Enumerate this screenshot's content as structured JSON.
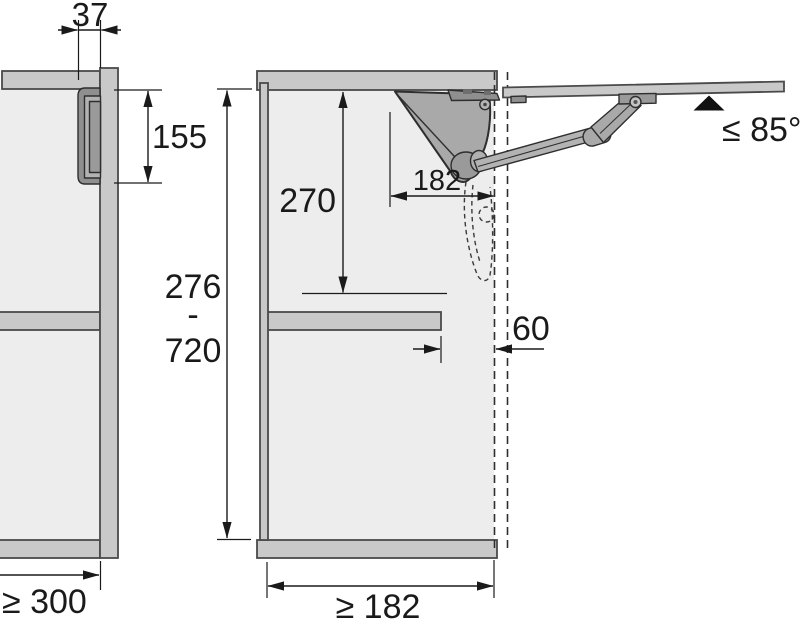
{
  "diagram": {
    "type": "technical-installation-drawing",
    "subject": "cabinet lift-up flap fitting mounting dimensions, front view and side section view",
    "dimensions": {
      "fitting_front_width": "37",
      "fitting_front_height": "155",
      "min_cabinet_side_depth": "≥ 300",
      "interior_clearance_height": "270",
      "fitting_depth": "182",
      "shelf_setback": "60",
      "min_interior_depth": "≥ 182",
      "flap_height_min": "276",
      "flap_height_separator": "-",
      "flap_height_max": "720",
      "max_opening_angle": "≤ 85°"
    },
    "colors": {
      "panel": "#c9c9c9",
      "interior": "#ededed",
      "mechanism_body": "#a9a9a9",
      "mechanism_bracket": "#8f8f8f",
      "arm": "#b3b3b3",
      "outline": "#2e2e2e",
      "dimension": "#1a1a1a",
      "background": "#ffffff"
    }
  }
}
